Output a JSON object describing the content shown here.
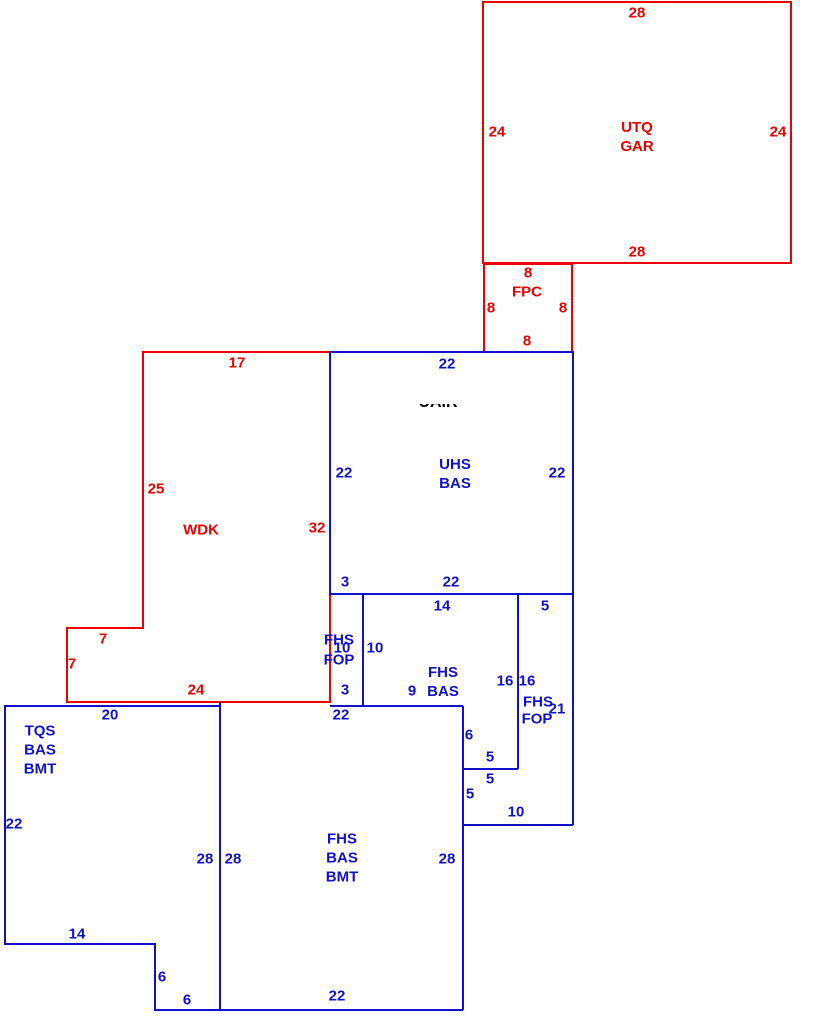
{
  "colors": {
    "red": "#ee0000",
    "blue": "#1111cc",
    "black": "#000000"
  },
  "sketch": {
    "width": 813,
    "height": 1020,
    "shapes": [
      {
        "name": "utq-gar-outline",
        "color": "red",
        "closed": true,
        "points": [
          [
            483,
            2
          ],
          [
            791,
            2
          ],
          [
            791,
            263
          ],
          [
            483,
            263
          ]
        ]
      },
      {
        "name": "fpc-outline",
        "color": "red",
        "closed": true,
        "points": [
          [
            484,
            264
          ],
          [
            572,
            264
          ],
          [
            572,
            352
          ],
          [
            484,
            352
          ]
        ]
      },
      {
        "name": "wdk-outline",
        "color": "red",
        "closed": false,
        "points": [
          [
            330,
            352
          ],
          [
            143,
            352
          ],
          [
            143,
            628
          ],
          [
            67,
            628
          ],
          [
            67,
            702
          ],
          [
            330,
            702
          ],
          [
            330,
            594
          ]
        ]
      },
      {
        "name": "uhs-bas-outline",
        "color": "blue",
        "closed": true,
        "points": [
          [
            330,
            352
          ],
          [
            573,
            352
          ],
          [
            573,
            594
          ],
          [
            330,
            594
          ]
        ]
      },
      {
        "name": "fop-strip-divider",
        "color": "blue",
        "closed": false,
        "points": [
          [
            363,
            594
          ],
          [
            363,
            706
          ]
        ]
      },
      {
        "name": "fhs-bas-bottom",
        "color": "blue",
        "closed": false,
        "points": [
          [
            330,
            706
          ],
          [
            463,
            706
          ]
        ]
      },
      {
        "name": "fop-left-edge",
        "color": "blue",
        "closed": false,
        "points": [
          [
            518,
            594
          ],
          [
            518,
            769
          ]
        ]
      },
      {
        "name": "fop-step-line",
        "color": "blue",
        "closed": false,
        "points": [
          [
            463,
            769
          ],
          [
            518,
            769
          ]
        ]
      },
      {
        "name": "fop-right-edge",
        "color": "blue",
        "closed": false,
        "points": [
          [
            573,
            594
          ],
          [
            573,
            825
          ]
        ]
      },
      {
        "name": "fop-bottom-line",
        "color": "blue",
        "closed": false,
        "points": [
          [
            463,
            825
          ],
          [
            573,
            825
          ]
        ]
      },
      {
        "name": "fhs-right-edge",
        "color": "blue",
        "closed": false,
        "points": [
          [
            463,
            706
          ],
          [
            463,
            1010
          ]
        ]
      },
      {
        "name": "tqs-outline",
        "color": "blue",
        "closed": false,
        "points": [
          [
            220,
            706
          ],
          [
            5,
            706
          ],
          [
            5,
            944
          ],
          [
            155,
            944
          ],
          [
            155,
            1010
          ],
          [
            463,
            1010
          ]
        ]
      },
      {
        "name": "tqs-fhs-divider",
        "color": "blue",
        "closed": false,
        "points": [
          [
            220,
            702
          ],
          [
            220,
            1010
          ]
        ]
      }
    ],
    "labels": [
      {
        "name": "gar-dim-top",
        "text": "28",
        "x": 637,
        "y": 13,
        "color": "red"
      },
      {
        "name": "gar-dim-left",
        "text": "24",
        "x": 497,
        "y": 132,
        "color": "red"
      },
      {
        "name": "utq-gar-label",
        "text": "UTQ\nGAR",
        "x": 637,
        "y": 137,
        "color": "red"
      },
      {
        "name": "gar-dim-right",
        "text": "24",
        "x": 778,
        "y": 132,
        "color": "red"
      },
      {
        "name": "gar-dim-bottom",
        "text": "28",
        "x": 637,
        "y": 252,
        "color": "red"
      },
      {
        "name": "fpc-dim-top",
        "text": "8",
        "x": 528,
        "y": 273,
        "color": "red"
      },
      {
        "name": "fpc-label",
        "text": "FPC",
        "x": 527,
        "y": 292,
        "color": "red"
      },
      {
        "name": "fpc-dim-left",
        "text": "8",
        "x": 491,
        "y": 308,
        "color": "red"
      },
      {
        "name": "fpc-dim-right",
        "text": "8",
        "x": 563,
        "y": 308,
        "color": "red"
      },
      {
        "name": "fpc-dim-bottom",
        "text": "8",
        "x": 527,
        "y": 341,
        "color": "red"
      },
      {
        "name": "wdk-dim-top",
        "text": "17",
        "x": 237,
        "y": 363,
        "color": "red"
      },
      {
        "name": "wdk-dim-left",
        "text": "25",
        "x": 156,
        "y": 489,
        "color": "red"
      },
      {
        "name": "wdk-label",
        "text": "WDK",
        "x": 201,
        "y": 530,
        "color": "red"
      },
      {
        "name": "wdk-dim-right",
        "text": "32",
        "x": 317,
        "y": 528,
        "color": "red"
      },
      {
        "name": "wdk-notch-dim-h",
        "text": "7",
        "x": 103,
        "y": 639,
        "color": "red"
      },
      {
        "name": "wdk-notch-dim-v",
        "text": "7",
        "x": 72,
        "y": 664,
        "color": "red"
      },
      {
        "name": "wdk-dim-bottom",
        "text": "24",
        "x": 196,
        "y": 690,
        "color": "red"
      },
      {
        "name": "uhs-dim-top",
        "text": "22",
        "x": 447,
        "y": 364,
        "color": "blue"
      },
      {
        "name": "clipped-black-text",
        "text": "UAIR",
        "x": 407,
        "y": 404,
        "color": "black",
        "clip": {
          "w": 62,
          "h": 11,
          "shift": -9
        }
      },
      {
        "name": "uhs-dim-left",
        "text": "22",
        "x": 344,
        "y": 473,
        "color": "blue"
      },
      {
        "name": "uhs-bas-label",
        "text": "UHS\nBAS",
        "x": 455,
        "y": 474,
        "color": "blue"
      },
      {
        "name": "uhs-dim-right",
        "text": "22",
        "x": 557,
        "y": 473,
        "color": "blue"
      },
      {
        "name": "uhs-dim-bottom-left",
        "text": "3",
        "x": 345,
        "y": 582,
        "color": "blue"
      },
      {
        "name": "uhs-dim-bottom",
        "text": "22",
        "x": 451,
        "y": 582,
        "color": "blue"
      },
      {
        "name": "fhsbas-dim-top",
        "text": "14",
        "x": 442,
        "y": 606,
        "color": "blue"
      },
      {
        "name": "fop-right-dim-top",
        "text": "5",
        "x": 545,
        "y": 606,
        "color": "blue"
      },
      {
        "name": "fop-strip-fhs",
        "text": "FHS",
        "x": 339,
        "y": 640,
        "color": "blue"
      },
      {
        "name": "fop-strip-dim-10a",
        "text": "10",
        "x": 342,
        "y": 648,
        "color": "blue"
      },
      {
        "name": "fop-strip-dim-10b",
        "text": "10",
        "x": 375,
        "y": 648,
        "color": "blue"
      },
      {
        "name": "fop-strip-fop",
        "text": "FOP",
        "x": 339,
        "y": 660,
        "color": "blue"
      },
      {
        "name": "fhs-bas-label",
        "text": "FHS\nBAS",
        "x": 443,
        "y": 682,
        "color": "blue"
      },
      {
        "name": "fhsbas-dim-bottom",
        "text": "9",
        "x": 412,
        "y": 691,
        "color": "blue"
      },
      {
        "name": "fhsbas-dim-right",
        "text": "16",
        "x": 505,
        "y": 681,
        "color": "blue"
      },
      {
        "name": "fop-right-dim-left",
        "text": "16",
        "x": 527,
        "y": 681,
        "color": "blue"
      },
      {
        "name": "fop-right-fhs",
        "text": "FHS",
        "x": 538,
        "y": 702,
        "color": "blue"
      },
      {
        "name": "fop-right-dim-21",
        "text": "21",
        "x": 557,
        "y": 709,
        "color": "blue"
      },
      {
        "name": "fop-right-fop",
        "text": "FOP",
        "x": 537,
        "y": 719,
        "color": "blue"
      },
      {
        "name": "fop-strip-dim-bottom",
        "text": "3",
        "x": 345,
        "y": 690,
        "color": "blue"
      },
      {
        "name": "fhsbmt-dim-top",
        "text": "22",
        "x": 341,
        "y": 715,
        "color": "blue"
      },
      {
        "name": "tqs-dim-top",
        "text": "20",
        "x": 110,
        "y": 715,
        "color": "blue"
      },
      {
        "name": "tqs-label",
        "text": "TQS\nBAS\nBMT",
        "x": 40,
        "y": 750,
        "color": "blue"
      },
      {
        "name": "tqs-dim-left",
        "text": "22",
        "x": 14,
        "y": 824,
        "color": "blue"
      },
      {
        "name": "step-dim-6",
        "text": "6",
        "x": 469,
        "y": 735,
        "color": "blue"
      },
      {
        "name": "step-dim-5a",
        "text": "5",
        "x": 490,
        "y": 757,
        "color": "blue"
      },
      {
        "name": "step-dim-5b",
        "text": "5",
        "x": 490,
        "y": 779,
        "color": "blue"
      },
      {
        "name": "step-dim-5c",
        "text": "5",
        "x": 470,
        "y": 794,
        "color": "blue"
      },
      {
        "name": "fop-dim-bottom",
        "text": "10",
        "x": 516,
        "y": 812,
        "color": "blue"
      },
      {
        "name": "tqs-dim-right",
        "text": "28",
        "x": 205,
        "y": 859,
        "color": "blue"
      },
      {
        "name": "fhsbmt-dim-left",
        "text": "28",
        "x": 233,
        "y": 859,
        "color": "blue"
      },
      {
        "name": "fhs-bmt-label",
        "text": "FHS\nBAS\nBMT",
        "x": 342,
        "y": 858,
        "color": "blue"
      },
      {
        "name": "fhsbmt-dim-right",
        "text": "28",
        "x": 447,
        "y": 859,
        "color": "blue"
      },
      {
        "name": "tqs-dim-bottom",
        "text": "14",
        "x": 77,
        "y": 934,
        "color": "blue"
      },
      {
        "name": "tqs-notch-dim-v",
        "text": "6",
        "x": 162,
        "y": 977,
        "color": "blue"
      },
      {
        "name": "tqs-notch-dim-h",
        "text": "6",
        "x": 187,
        "y": 1000,
        "color": "blue"
      },
      {
        "name": "fhsbmt-dim-bottom",
        "text": "22",
        "x": 337,
        "y": 996,
        "color": "blue"
      }
    ]
  }
}
